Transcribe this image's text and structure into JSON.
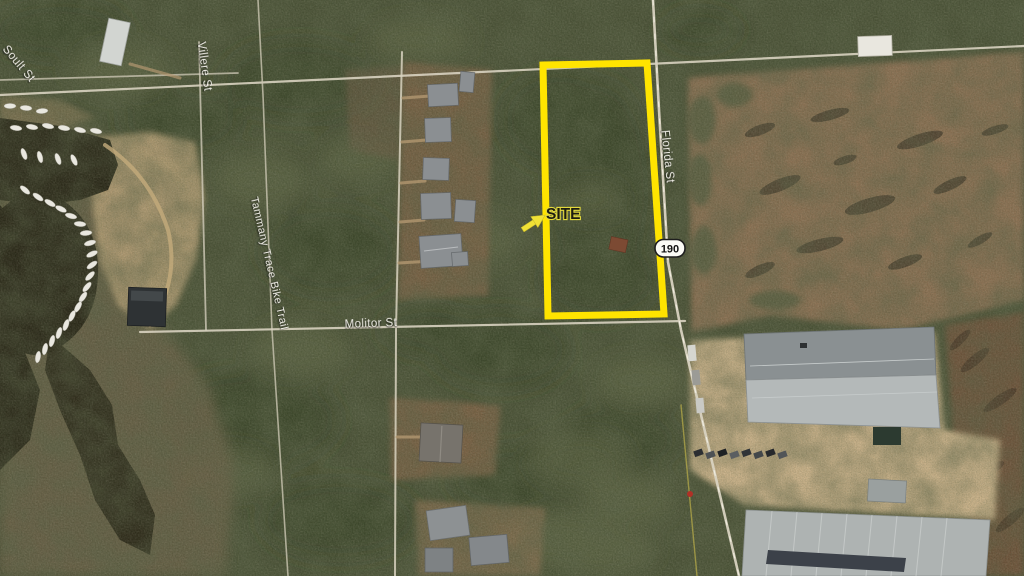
{
  "map": {
    "site_label": "SITE",
    "boundary_color": "#FFE400",
    "highway_shield_label": "190",
    "street_labels": {
      "soult": "Soult St",
      "villere": "Villere St",
      "tammany_trace": "Tammany Trace Bike Trail",
      "molitor": "Molitor St",
      "florida": "Florida St"
    }
  }
}
